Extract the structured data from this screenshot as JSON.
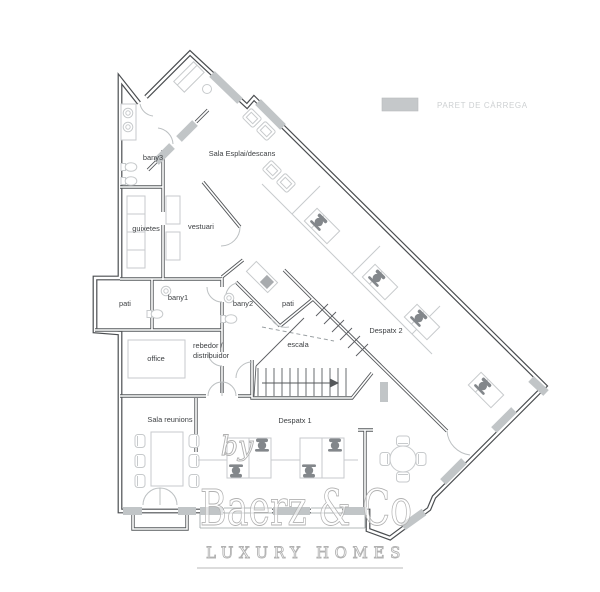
{
  "legend": {
    "label": "PARET DE CÀRREGA",
    "swatch_color": "#c5c8ca"
  },
  "rooms": {
    "bany3": "bany3",
    "sala_esplai": "Sala Esplai/descans",
    "guixetes": "guixetes",
    "vestuari": "vestuari",
    "pati_left": "pati",
    "bany1": "bany1",
    "bany2": "bany2",
    "pati_right": "pati",
    "office": "office",
    "hall_line1": "rebedor /",
    "hall_line2": "distribuidor",
    "escala": "escala",
    "despatx2": "Despatx 2",
    "sala_reunions": "Sala reunions",
    "despatx1": "Despatx 1"
  },
  "watermark": {
    "prefix": "by",
    "brand": "Baerz & Co",
    "tagline": "LUXURY HOMES"
  },
  "colors": {
    "wall": "#4b4e51",
    "bearing_wall": "#c1c5c7",
    "furniture": "#c7cacc",
    "chair_dark": "#83878b",
    "label_text": "#3c3f42",
    "legend_text": "#cdd0d2",
    "watermark": "#b1b1b1"
  }
}
